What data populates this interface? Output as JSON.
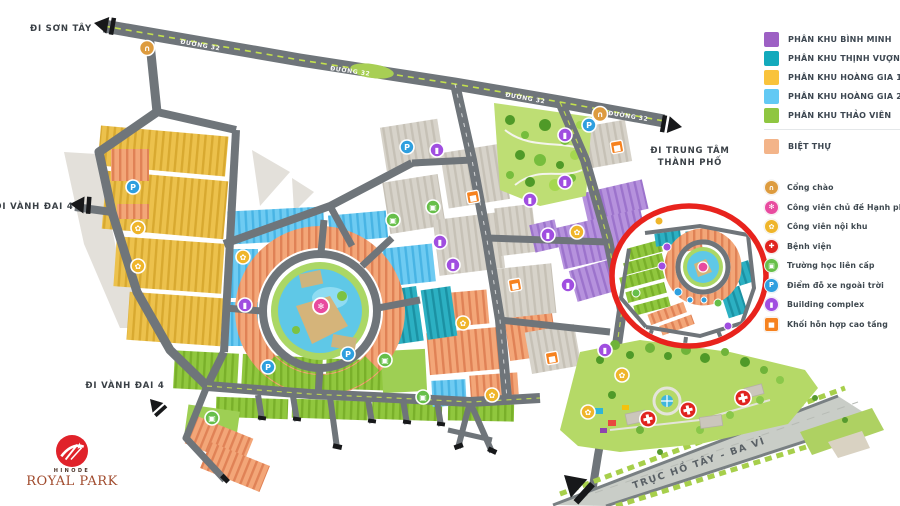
{
  "map": {
    "labels": {
      "son_tay": "ĐI SƠN TÂY",
      "vanh_dai_4": "ĐI VÀNH ĐAI 4",
      "trung_tam_1": "ĐI TRUNG TÂM",
      "trung_tam_2": "THÀNH PHỐ",
      "truc_ho_tay": "TRỤC HỒ TÂY - BA VÌ",
      "duong_32": "ĐƯỜNG 32"
    },
    "highlight_circle_color": "#e8231d"
  },
  "legend": {
    "zones": [
      {
        "label": "PHÂN KHU BÌNH MINH",
        "color": "#9d60c4"
      },
      {
        "label": "PHÂN KHU THỊNH VƯỢNG",
        "color": "#13aabc"
      },
      {
        "label": "PHÂN KHU HOÀNG GIA 1",
        "color": "#f9c33c"
      },
      {
        "label": "PHÂN KHU HOÀNG GIA 2",
        "color": "#62c9f4"
      },
      {
        "label": "PHÂN KHU THẢO VIÊN",
        "color": "#8fc641"
      },
      {
        "label": "BIỆT THỰ",
        "color": "#f3b489"
      }
    ],
    "amenities": [
      {
        "label": "Cổng chào",
        "color": "#dd9b3e",
        "glyph": "∩"
      },
      {
        "label": "Công viên chủ đề Hạnh phúc",
        "color": "#e84b9f",
        "glyph": "✻"
      },
      {
        "label": "Công viên nội khu",
        "color": "#efb52a",
        "glyph": "✿"
      },
      {
        "label": "Bệnh viện",
        "color": "#e0231f",
        "glyph": "✚"
      },
      {
        "label": "Trường học liên cấp",
        "color": "#67bf4a",
        "glyph": "▣"
      },
      {
        "label": "Điểm đỗ xe ngoài trời",
        "color": "#2e9fdf",
        "glyph": "P"
      },
      {
        "label": "Building complex",
        "color": "#a04ee0",
        "glyph": "▮"
      },
      {
        "label": "Khối hỗn hợp cao tầng",
        "color": "#f6821f",
        "glyph": "▅"
      }
    ]
  },
  "logo": {
    "brand": "HINODE",
    "name": "ROYAL PARK"
  }
}
